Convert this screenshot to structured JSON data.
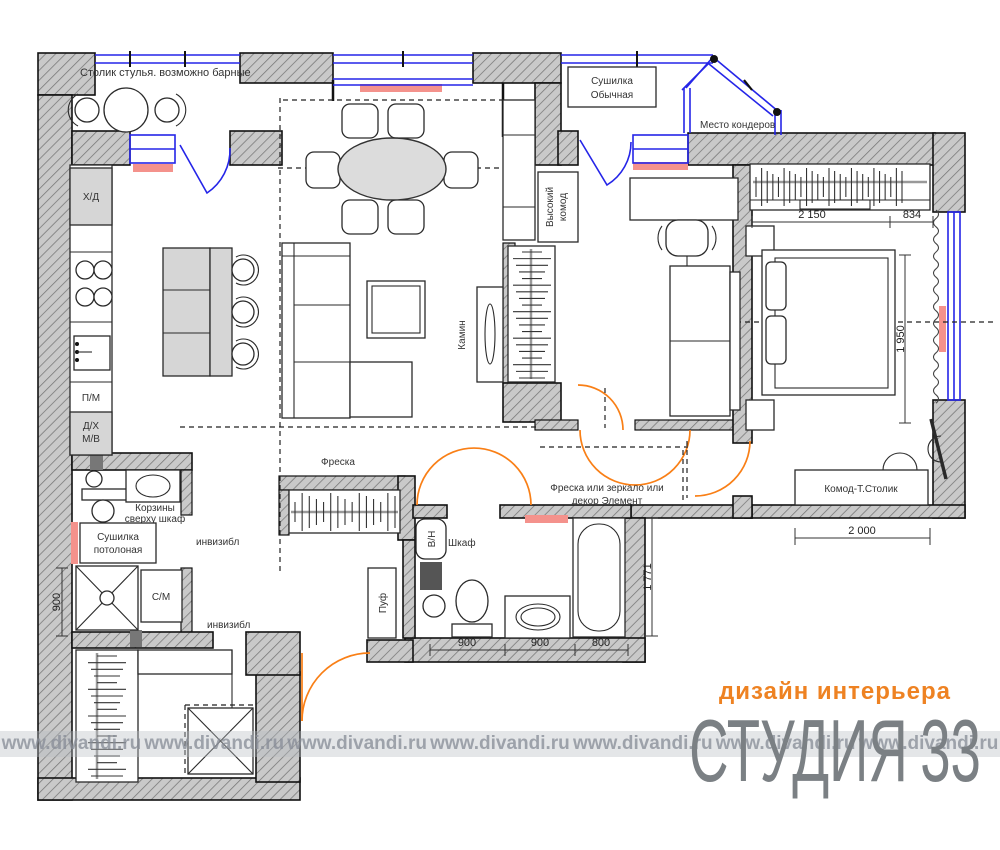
{
  "plan": {
    "labels": {
      "balcony_note": "Столик стулья. возможно барные",
      "fridge": "Х/Д",
      "dishwasher": "П/М",
      "oven1": "Д/Х",
      "oven2": "М/В",
      "dryer1": "Сушилка",
      "dryer2": "Обычная",
      "ac_place": "Место кондеров",
      "tall_dresser1": "Высокий",
      "tall_dresser2": "комод",
      "fireplace": "Камин",
      "fresco": "Фреска",
      "fresco_decor1": "Фреска или зеркало или",
      "fresco_decor2": "декор Элемент",
      "dresser_table": "Комод-Т.Столик",
      "wardrobe": "Шкаф",
      "water_heater": "В/Н",
      "pouf": "Пуф",
      "baskets1": "Корзины",
      "baskets2": "сверху шкаф",
      "ceiling_dryer1": "Сушилка",
      "ceiling_dryer2": "потолоная",
      "washer": "С/М",
      "invisible_a": "инвизибл",
      "invisible_b": "инвизибл"
    },
    "dimensions": {
      "bed_width": "2 150",
      "bed_right": "834",
      "bed_length": "1 950",
      "commode": "2 000",
      "bath": "1 771",
      "shower": "900",
      "wc_a": "900",
      "wc_b": "900",
      "tub": "800"
    },
    "colors": {
      "wall_fill": "#c9c9c9",
      "window_blue": "#2525e8",
      "door_orange": "#f97f16",
      "radiator_pink": "#f4928c",
      "logo_orange": "#ee8222",
      "logo_gray": "#7b8084"
    }
  },
  "watermark": {
    "text": "www.divandi.ru"
  },
  "logo": {
    "tagline": "дизайн интерьера",
    "studio": "СТУДИЯ",
    "number": "33"
  }
}
